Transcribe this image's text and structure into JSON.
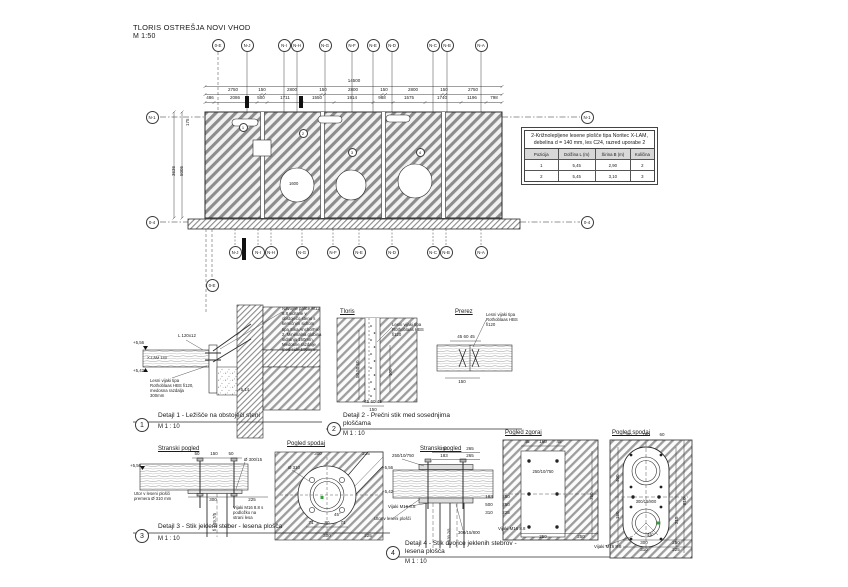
{
  "title": {
    "text": "TLORIS OSTREŠJA NOVI VHOD",
    "scale": "M 1:50"
  },
  "plan": {
    "grid_top": [
      "0-E",
      "N-J",
      "N-I",
      "N-H",
      "N-G",
      "N-F",
      "N-E",
      "N-D",
      "N-C",
      "N-B",
      "N-A"
    ],
    "grid_bottom": [
      "N-J",
      "N-I",
      "N-H",
      "N-G",
      "N-F",
      "N-E",
      "N-D",
      "N-C",
      "N-B",
      "N-A"
    ],
    "grid_bottom_left": "0-E",
    "grid_left": [
      "N-1",
      "0-4"
    ],
    "grid_right": [
      "N-1",
      "0-4"
    ],
    "dim_total": "14500",
    "dims_mid": [
      "2750",
      "150",
      "2800",
      "150",
      "2800",
      "150",
      "2800",
      "150",
      "2750"
    ],
    "dims_bottom": [
      "486",
      "2086",
      "500",
      "1711",
      "1550",
      "1914",
      "988",
      "1575",
      "1740",
      "1196",
      "798"
    ],
    "dims_left": [
      "175",
      "3636",
      "5005"
    ],
    "opening_label": "1600",
    "callouts": [
      "1",
      "2",
      "3",
      "4"
    ]
  },
  "table": {
    "title": "2-Križnolepljene lesene plošče tipa Noritec X-LAM, debelina d = 140 mm, les C24, razred uporabe 2",
    "headers": [
      "Pozicija",
      "Dolžina L (m)",
      "Širina B (m)",
      "Količina"
    ],
    "rows": [
      [
        "1",
        "5,45",
        "2,90",
        "2"
      ],
      [
        "2",
        "5,45",
        "3,10",
        "3"
      ]
    ]
  },
  "detail1": {
    "number": "1",
    "caption": "Detajl 1 - Ležišče na obstoječi steni",
    "scale": "M 1 : 10",
    "ann_anchor": "Navojne palice M12 8.8 sidrane v obstoječo steno s kemičnim sidrom tipa Sika AnchorFix-2, Minimalna globina sidranja 160mm, Medosne razdalje med sidri 500mm",
    "ann_screw": "Lesni vijaki tipa Rothoblaas HBS fi120, medosna razdalja 300mm",
    "label_angle": "L 120x12",
    "label_panel": "X-LAM 140",
    "elev_top": "+5,56",
    "elev_bottom": "+5,42",
    "elev_wall": "+5,14"
  },
  "detail2": {
    "number": "2",
    "caption_line1": "Detajl 2 - Prečni stik med sosednjima",
    "caption_line2": "ploščama",
    "scale": "M 1 : 10",
    "view_plan": "Tloris",
    "view_section": "Prerez",
    "ann_screw": "Lesni vijaki tipa Rothoblaas HBS fi120",
    "dim_top": "45 60 45",
    "dim_width": "150",
    "dim_side": "50 50 50",
    "dim_len": "100"
  },
  "detail3": {
    "number": "3",
    "caption": "Detajl 3 - Stik jekleni steber - lesena plošča",
    "scale": "M 1 : 10",
    "view_side": "Stranski pogled",
    "view_bottom": "Pogled spodaj",
    "elev": "+5,56",
    "dims_side_top": [
      "50",
      "150",
      "50"
    ],
    "label_plate": "Ø 300/15",
    "label_pipe": "fi 139.7/5",
    "dims_side_bottom": [
      "300",
      "225"
    ],
    "ann_groove": "Utor v leseni plošči premera Ø 310 mm",
    "ann_bolts": "Vijaki M16 8.8 s podložko na strani lesa",
    "bv": {
      "d_hole": "Ø 310",
      "angle": "45°",
      "dims_top": [
        "300",
        "225"
      ],
      "dims_mid": [
        "71",
        "80",
        "71"
      ],
      "dims_bottom": [
        "300",
        "225"
      ]
    }
  },
  "detail4": {
    "number": "4",
    "caption_line1": "Detajl 4 - Stik dvojice jeklenih stebrov -",
    "caption_line2": "lesena plošča",
    "scale": "M 1 : 10",
    "view_side": "Stranski pogled",
    "view_top": "Pogled zgoraj",
    "view_bottom": "Pogled spodaj",
    "elev_top": "+5,56",
    "elev_bottom": "+5,42",
    "label_top_plate": "250/10/750",
    "label_bottom_plate": "300/15/800",
    "label_pipe": "fi 139.7/5",
    "ann_bolts": "Vijaki M16 8.8",
    "ann_groove": "Utor v leseni plošči",
    "dims_top": [
      "250",
      "265",
      "183",
      "265"
    ],
    "dims_right": [
      "183",
      "250",
      "500",
      "250",
      "310",
      "225"
    ],
    "top_view": {
      "dims_top": [
        "45",
        "160",
        "45"
      ],
      "plate_label": "250/10/750",
      "dims_bottom": [
        "250",
        "250"
      ],
      "dim_right": "750",
      "ann_bolts": "Vijaki M16 8.8"
    },
    "bottom_view": {
      "plate_label": "300/15/800",
      "angle": "45°",
      "dims_top": [
        "60",
        "180",
        "60"
      ],
      "dims_left": [
        "400",
        "150"
      ],
      "dims_right": [
        "215",
        "810"
      ],
      "dims_bottom1": [
        "300",
        "250"
      ],
      "dims_bottom2": [
        "310",
        "225"
      ],
      "ann_bolts": "Vijaki M16 8.8"
    }
  }
}
